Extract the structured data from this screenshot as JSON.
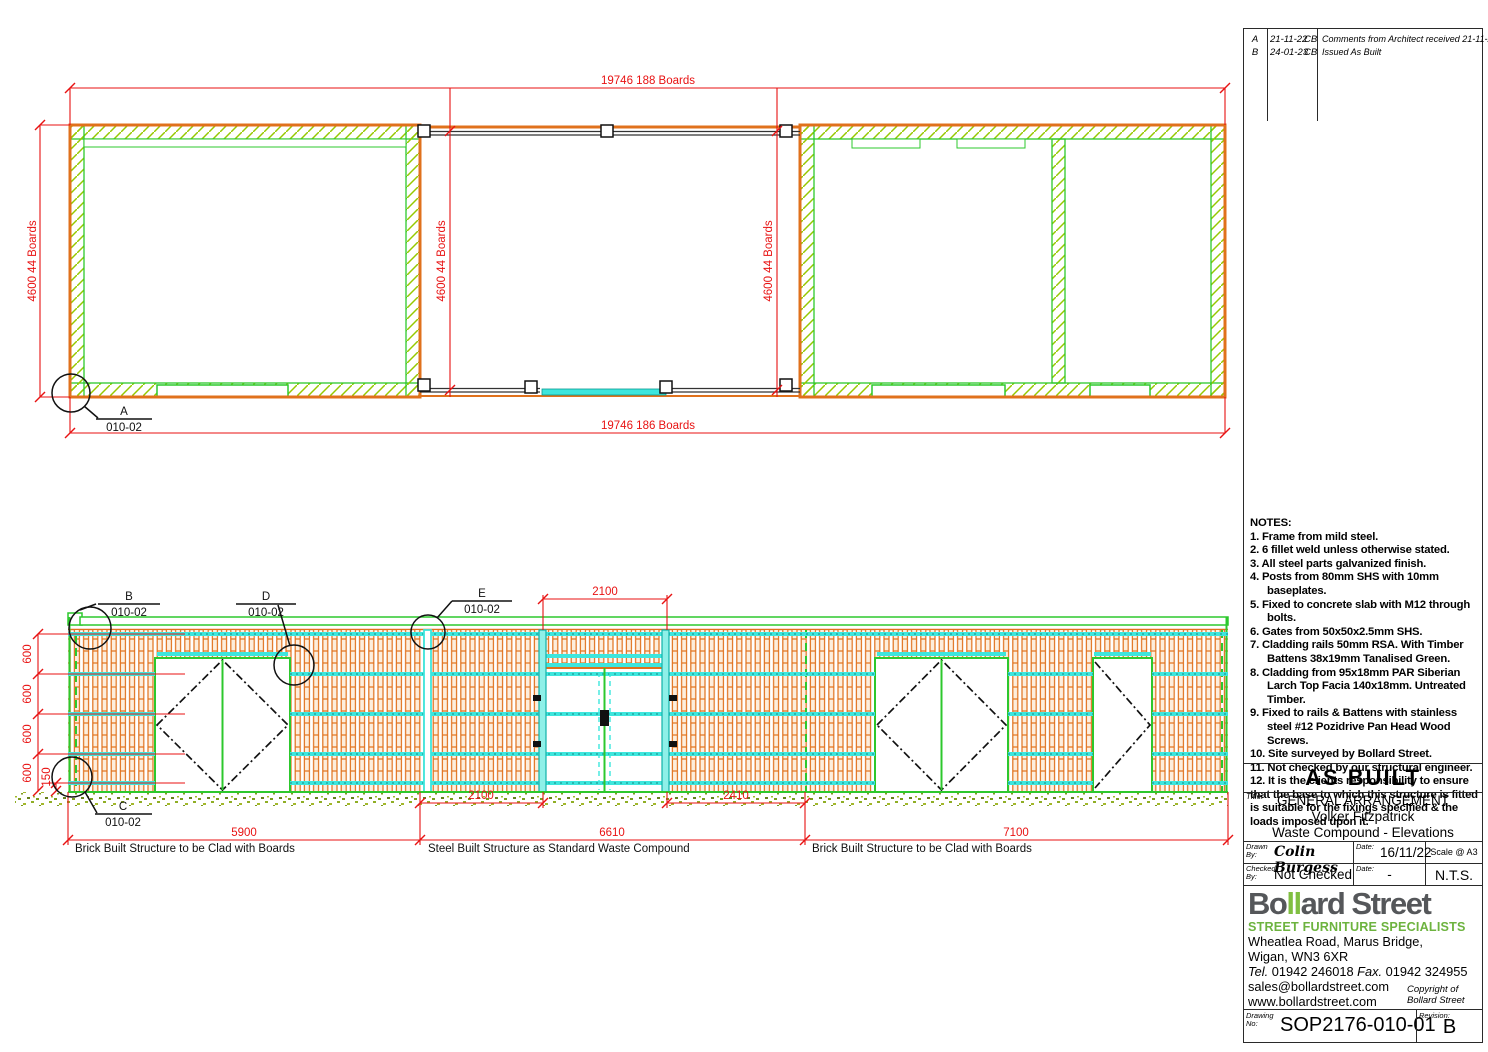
{
  "colors": {
    "dim_red": "#e81212",
    "structure_orange": "#e0711c",
    "frame_green": "#2dc82d",
    "hatch_green": "#96c800",
    "rail_cyan": "#3de6dd",
    "logo_green": "#80bf41",
    "logo_gray": "#55575a"
  },
  "revisions": {
    "rows": [
      {
        "rev": "A",
        "date": "21-11-22",
        "by": "CB",
        "desc": "Comments from Architect received 21-11-22"
      },
      {
        "rev": "B",
        "date": "24-01-23",
        "by": "CB",
        "desc": "Issued As Built"
      }
    ]
  },
  "plan": {
    "dim_top": "19746 188 Boards",
    "dim_bottom": "19746 186 Boards",
    "dim_left": "4600 44 Boards",
    "dim_mid_left": "4600 44 Boards",
    "dim_mid_right": "4600 44 Boards",
    "callout_a_label": "A",
    "callout_a_ref": "010-02"
  },
  "elevation": {
    "callout_b_label": "B",
    "callout_b_ref": "010-02",
    "callout_c_label": "C",
    "callout_c_ref": "010-02",
    "callout_d_label": "D",
    "callout_d_ref": "010-02",
    "callout_e_label": "E",
    "callout_e_ref": "010-02",
    "dim_gate_top": "2100",
    "dim_600_1": "600",
    "dim_600_2": "600",
    "dim_600_3": "600",
    "dim_600_4": "600",
    "dim_150": "150",
    "dim_2100": "2100",
    "dim_2410": "2410",
    "dim_5900": "5900",
    "dim_6610": "6610",
    "dim_7100": "7100",
    "label_left": "Brick Built Structure to be Clad with Boards",
    "label_mid": "Steel Built Structure as Standard Waste Compound",
    "label_right": "Brick Built Structure to be Clad with Boards"
  },
  "notes": {
    "heading": "NOTES:",
    "items": [
      "1.  Frame from mild steel.",
      "2.  6 fillet weld unless otherwise stated.",
      "3.  All steel parts galvanized finish.",
      "4.  Posts from 80mm SHS with 10mm baseplates.",
      "5.  Fixed to concrete slab with M12 through bolts.",
      "6.  Gates from 50x50x2.5mm SHS.",
      "7.  Cladding rails 50mm RSA. With Timber Battens 38x19mm Tanalised Green.",
      "8.  Cladding from 95x18mm PAR Siberian Larch Top Facia 140x18mm. Untreated Timber.",
      "9.  Fixed to rails & Battens with stainless steel #12 Pozidrive Pan Head Wood Screws.",
      "10. Site surveyed by Bollard Street.",
      "11. Not checked by our structural engineer.",
      "12. It is the clients responsibility to ensure that the base to which this structure is fitted is suitable for the fixings specified & the loads imposed upon it."
    ]
  },
  "stamp": {
    "text": "AS BUILT"
  },
  "title_block": {
    "title_label": "Title:",
    "title_line1": "GENERAL ARRANGEMENT",
    "title_line2": "Volker Fitzpatrick",
    "title_line3": "Waste Compound - Elevations",
    "drawn_label": "Drawn By:",
    "drawn_value": "Colin Burgess",
    "date1_label": "Date:",
    "date1_value": "16/11/22",
    "scale_label": "Scale @ A3",
    "scale_value": "N.T.S.",
    "checked_label": "Checked By:",
    "checked_value": "Not Checked",
    "date2_label": "Date:",
    "date2_value": "-"
  },
  "company": {
    "logo_part1": "Bo",
    "logo_part2": "ll",
    "logo_part3": "ard Street",
    "tagline": "STREET FURNITURE SPECIALISTS",
    "address1": "Wheatlea Road, Marus Bridge,",
    "address2": "Wigan, WN3 6XR",
    "tel_label": "Tel.",
    "tel": "01942 246018",
    "fax_label": "Fax.",
    "fax": "01942 324955",
    "email": "sales@bollardstreet.com",
    "web": "www.bollardstreet.com",
    "copyright1": "Copyright of",
    "copyright2": "Bollard Street"
  },
  "drawing_info": {
    "number_label": "Drawing No:",
    "number": "SOP2176-010-01",
    "revision_label": "Revision:",
    "revision": "B"
  }
}
